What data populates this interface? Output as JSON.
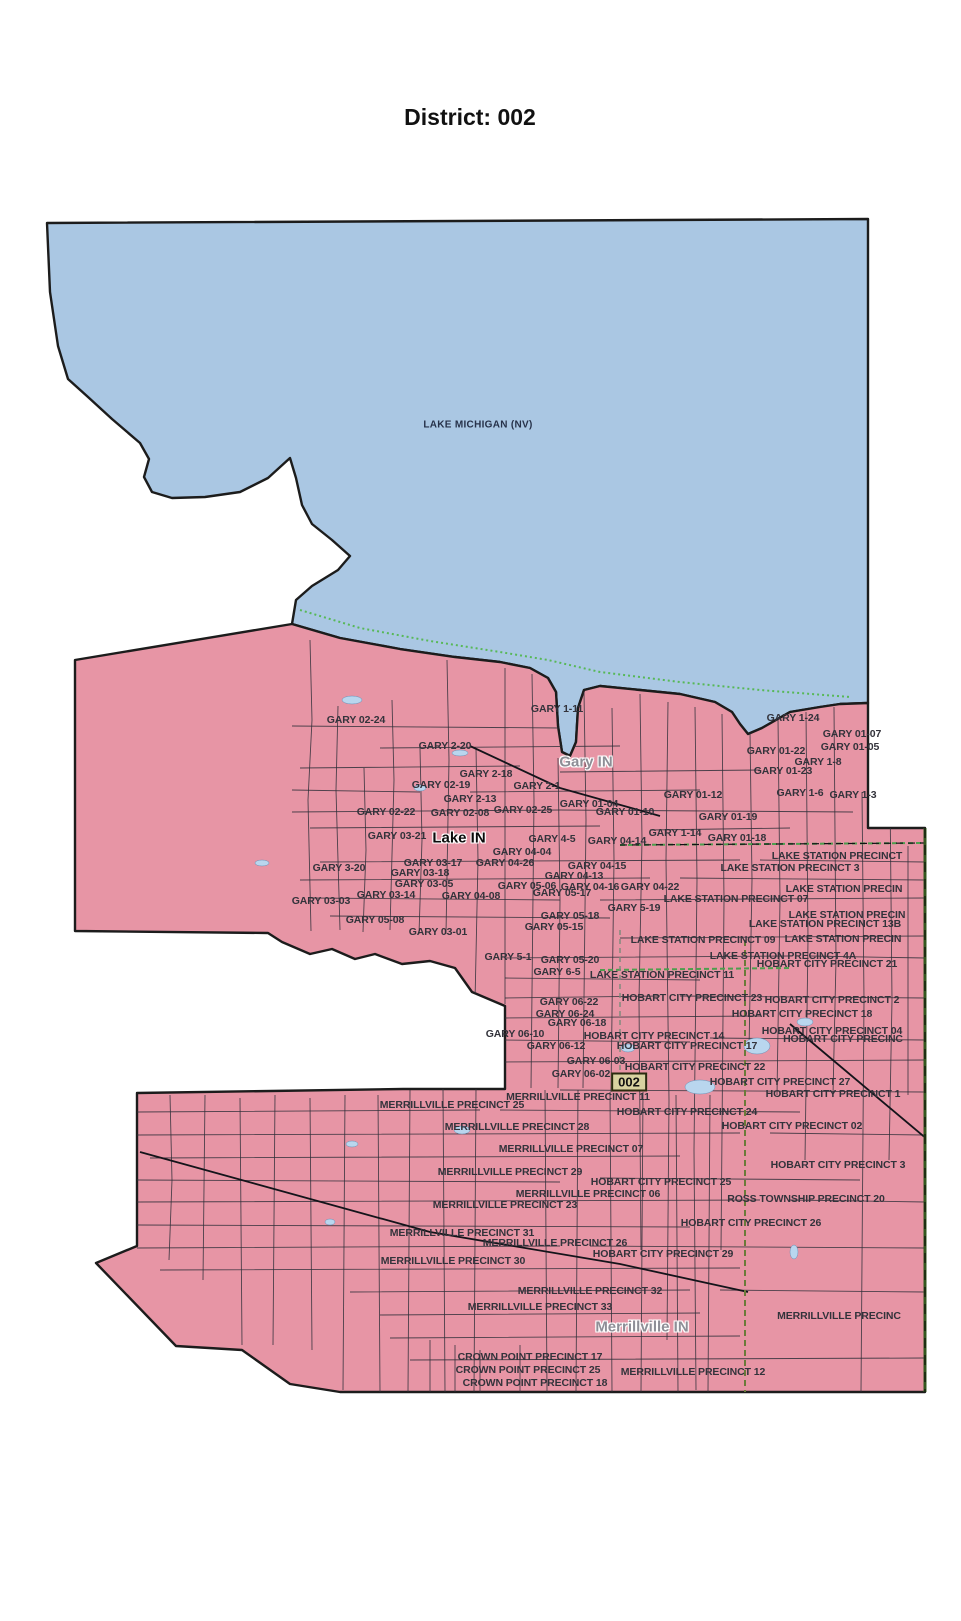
{
  "page": {
    "title": "District: 002"
  },
  "map": {
    "water_label": {
      "text": "LAKE MICHIGAN (NV)",
      "x": 478,
      "y": 425
    },
    "city_labels": [
      {
        "text": "Gary IN",
        "x": 586,
        "y": 762,
        "variant": "gray"
      },
      {
        "text": "Lake IN",
        "x": 459,
        "y": 838,
        "variant": "dark"
      },
      {
        "text": "Merrillville IN",
        "x": 642,
        "y": 1327,
        "variant": "gray"
      }
    ],
    "district_badge": {
      "text": "002",
      "x": 629,
      "y": 1082
    },
    "precinct_labels": [
      {
        "text": "GARY 02-24",
        "x": 356,
        "y": 720
      },
      {
        "text": "GARY 1-11",
        "x": 557,
        "y": 709
      },
      {
        "text": "GARY 1-24",
        "x": 793,
        "y": 718
      },
      {
        "text": "GARY 01-07",
        "x": 852,
        "y": 734
      },
      {
        "text": "GARY 01-05",
        "x": 850,
        "y": 747
      },
      {
        "text": "GARY 2-20",
        "x": 445,
        "y": 746
      },
      {
        "text": "GARY 01-22",
        "x": 776,
        "y": 751
      },
      {
        "text": "GARY 1-8",
        "x": 818,
        "y": 762
      },
      {
        "text": "GARY 2-18",
        "x": 486,
        "y": 774
      },
      {
        "text": "GARY 01-23",
        "x": 783,
        "y": 771
      },
      {
        "text": "GARY 02-19",
        "x": 441,
        "y": 785
      },
      {
        "text": "GARY 2-1",
        "x": 537,
        "y": 786
      },
      {
        "text": "GARY 01-12",
        "x": 693,
        "y": 795
      },
      {
        "text": "GARY 1-6",
        "x": 800,
        "y": 793
      },
      {
        "text": "GARY 1-3",
        "x": 853,
        "y": 795
      },
      {
        "text": "GARY 2-13",
        "x": 470,
        "y": 799
      },
      {
        "text": "GARY 02-22",
        "x": 386,
        "y": 812
      },
      {
        "text": "GARY 02-08",
        "x": 460,
        "y": 813
      },
      {
        "text": "GARY 02-25",
        "x": 523,
        "y": 810
      },
      {
        "text": "GARY 01-04",
        "x": 589,
        "y": 804
      },
      {
        "text": "GARY 01-10",
        "x": 625,
        "y": 812
      },
      {
        "text": "GARY 01-19",
        "x": 728,
        "y": 817
      },
      {
        "text": "GARY 03-21",
        "x": 397,
        "y": 836
      },
      {
        "text": "GARY 4-5",
        "x": 552,
        "y": 839
      },
      {
        "text": "GARY 1-14",
        "x": 675,
        "y": 833
      },
      {
        "text": "GARY 01-18",
        "x": 737,
        "y": 838
      },
      {
        "text": "GARY 04-14",
        "x": 617,
        "y": 841
      },
      {
        "text": "GARY 04-04",
        "x": 522,
        "y": 852
      },
      {
        "text": "GARY 3-20",
        "x": 339,
        "y": 868
      },
      {
        "text": "GARY 03-17",
        "x": 433,
        "y": 863
      },
      {
        "text": "GARY 04-26",
        "x": 505,
        "y": 863
      },
      {
        "text": "GARY 04-15",
        "x": 597,
        "y": 866
      },
      {
        "text": "GARY 03-18",
        "x": 420,
        "y": 873
      },
      {
        "text": "GARY 04-13",
        "x": 574,
        "y": 876
      },
      {
        "text": "GARY 03-05",
        "x": 424,
        "y": 884
      },
      {
        "text": "GARY 05-06",
        "x": 527,
        "y": 886
      },
      {
        "text": "GARY 04-16",
        "x": 590,
        "y": 887
      },
      {
        "text": "GARY 04-22",
        "x": 650,
        "y": 887
      },
      {
        "text": "GARY 03-03",
        "x": 321,
        "y": 901
      },
      {
        "text": "GARY 03-14",
        "x": 386,
        "y": 895
      },
      {
        "text": "GARY 04-08",
        "x": 471,
        "y": 896
      },
      {
        "text": "GARY 05-17",
        "x": 562,
        "y": 893
      },
      {
        "text": "GARY 5-19",
        "x": 634,
        "y": 908
      },
      {
        "text": "GARY 05-08",
        "x": 375,
        "y": 920
      },
      {
        "text": "GARY 05-18",
        "x": 570,
        "y": 916
      },
      {
        "text": "GARY 05-15",
        "x": 554,
        "y": 927
      },
      {
        "text": "GARY 03-01",
        "x": 438,
        "y": 932
      },
      {
        "text": "GARY 5-1",
        "x": 508,
        "y": 957
      },
      {
        "text": "GARY 05-20",
        "x": 570,
        "y": 960
      },
      {
        "text": "GARY 6-5",
        "x": 557,
        "y": 972
      },
      {
        "text": "GARY 06-22",
        "x": 569,
        "y": 1002
      },
      {
        "text": "GARY 06-24",
        "x": 565,
        "y": 1014
      },
      {
        "text": "GARY 06-18",
        "x": 577,
        "y": 1023
      },
      {
        "text": "GARY 06-10",
        "x": 515,
        "y": 1034
      },
      {
        "text": "GARY 06-12",
        "x": 556,
        "y": 1046
      },
      {
        "text": "GARY 06-03",
        "x": 596,
        "y": 1061
      },
      {
        "text": "GARY 06-02",
        "x": 581,
        "y": 1074
      },
      {
        "text": "LAKE STATION PRECINCT",
        "x": 837,
        "y": 856
      },
      {
        "text": "LAKE STATION PRECINCT 3",
        "x": 790,
        "y": 868
      },
      {
        "text": "LAKE STATION PRECIN",
        "x": 844,
        "y": 889
      },
      {
        "text": "LAKE STATION PRECINCT 07",
        "x": 736,
        "y": 899
      },
      {
        "text": "LAKE STATION PRECIN",
        "x": 847,
        "y": 915
      },
      {
        "text": "LAKE STATION PRECINCT 13B",
        "x": 825,
        "y": 924
      },
      {
        "text": "LAKE STATION PRECINCT 09",
        "x": 703,
        "y": 940
      },
      {
        "text": "LAKE STATION PRECIN",
        "x": 843,
        "y": 939
      },
      {
        "text": "LAKE STATION PRECINCT 4A",
        "x": 783,
        "y": 956
      },
      {
        "text": "LAKE STATION PRECINCT 11",
        "x": 662,
        "y": 975
      },
      {
        "text": "HOBART CITY PRECINCT 21",
        "x": 827,
        "y": 964
      },
      {
        "text": "HOBART CITY PRECINCT 23",
        "x": 692,
        "y": 998
      },
      {
        "text": "HOBART CITY PRECINCT 2",
        "x": 832,
        "y": 1000
      },
      {
        "text": "HOBART CITY PRECINCT 18",
        "x": 802,
        "y": 1014
      },
      {
        "text": "HOBART CITY PRECINCT 14",
        "x": 654,
        "y": 1036
      },
      {
        "text": "HOBART CITY PRECINCT 04",
        "x": 832,
        "y": 1031
      },
      {
        "text": "HOBART CITY PRECINC",
        "x": 843,
        "y": 1039
      },
      {
        "text": "HOBART CITY PRECINCT 17",
        "x": 687,
        "y": 1046
      },
      {
        "text": "HOBART CITY PRECINCT 22",
        "x": 695,
        "y": 1067
      },
      {
        "text": "HOBART CITY PRECINCT 27",
        "x": 780,
        "y": 1082
      },
      {
        "text": "HOBART CITY PRECINCT 1",
        "x": 833,
        "y": 1094
      },
      {
        "text": "HOBART CITY PRECINCT 24",
        "x": 687,
        "y": 1112
      },
      {
        "text": "HOBART CITY PRECINCT 02",
        "x": 792,
        "y": 1126
      },
      {
        "text": "HOBART CITY PRECINCT 3",
        "x": 838,
        "y": 1165
      },
      {
        "text": "HOBART CITY PRECINCT 25",
        "x": 661,
        "y": 1182
      },
      {
        "text": "ROSS TOWNSHIP PRECINCT 20",
        "x": 806,
        "y": 1199
      },
      {
        "text": "HOBART CITY PRECINCT 26",
        "x": 751,
        "y": 1223
      },
      {
        "text": "HOBART CITY PRECINCT 29",
        "x": 663,
        "y": 1254
      },
      {
        "text": "MERRILLVILLE PRECINCT 11",
        "x": 578,
        "y": 1097
      },
      {
        "text": "MERRILLVILLE PRECINCT 25",
        "x": 452,
        "y": 1105
      },
      {
        "text": "MERRILLVILLE PRECINCT 28",
        "x": 517,
        "y": 1127
      },
      {
        "text": "MERRILLVILLE PRECINCT 07",
        "x": 571,
        "y": 1149
      },
      {
        "text": "MERRILLVILLE PRECINCT 29",
        "x": 510,
        "y": 1172
      },
      {
        "text": "MERRILLVILLE PRECINCT 06",
        "x": 588,
        "y": 1194
      },
      {
        "text": "MERRILLVILLE PRECINCT 23",
        "x": 505,
        "y": 1205
      },
      {
        "text": "MERRILLVILLE PRECINCT 31",
        "x": 462,
        "y": 1233
      },
      {
        "text": "MERRILLVILLE PRECINCT 26",
        "x": 555,
        "y": 1243
      },
      {
        "text": "MERRILLVILLE PRECINCT 30",
        "x": 453,
        "y": 1261
      },
      {
        "text": "MERRILLVILLE PRECINCT 32",
        "x": 590,
        "y": 1291
      },
      {
        "text": "MERRILLVILLE PRECINCT 33",
        "x": 540,
        "y": 1307
      },
      {
        "text": "MERRILLVILLE PRECINC",
        "x": 839,
        "y": 1316
      },
      {
        "text": "MERRILLVILLE PRECINCT 12",
        "x": 693,
        "y": 1372
      },
      {
        "text": "CROWN POINT PRECINCT 17",
        "x": 530,
        "y": 1357
      },
      {
        "text": "CROWN POINT PRECINCT 25",
        "x": 528,
        "y": 1370
      },
      {
        "text": "CROWN POINT PRECINCT 18",
        "x": 535,
        "y": 1383
      }
    ]
  },
  "colors": {
    "water": "#aac7e3",
    "district_fill": "#e795a5",
    "outline": "#1c1c1c",
    "precinct_label": "#33333b",
    "city_label": "#8e8e96",
    "badge_fill": "#d8d2a0",
    "boundary_green": "#4e9e4e",
    "border_olive": "#34571f"
  }
}
